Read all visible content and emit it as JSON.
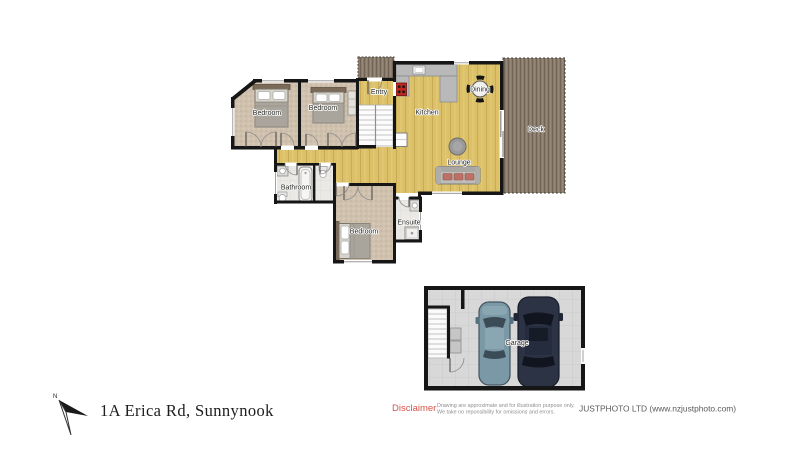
{
  "plan": {
    "rooms": {
      "entry": "Entry",
      "kitchen": "Kitchen",
      "dining": "Dining",
      "deck": "Deck",
      "lounge": "Lounge",
      "bedroom1": "Bedroom",
      "bedroom2": "Bedroom",
      "bedroom3": "Bedroom",
      "bathroom": "Bathroom",
      "ensuite": "Ensuite",
      "garage": "Garage"
    }
  },
  "footer": {
    "address": "1A Erica Rd,  Sunnynook",
    "compass": "N",
    "disclaimer_label": "Disclaimer",
    "disclaimer_line1": "Drawing are approximate and for illustration purpose only.",
    "disclaimer_line2": "We take no reponsibility for omissions and errors.",
    "company": "JUSTPHOTO LTD (www.nzjustphoto.com)"
  },
  "colors": {
    "wall": "#161616",
    "wood_floor": "#dcc168",
    "deck_wood": "#8a7c6c",
    "carpet": "#cfc1ae",
    "tile": "#ebe9e5",
    "counter_gray": "#b9b9b9",
    "garage_floor": "#d8d8d8",
    "stove_red": "#c2271e",
    "car_blue": "#7b98a7",
    "car_dark": "#2c3344",
    "disclaimer_red": "#d9534a"
  }
}
